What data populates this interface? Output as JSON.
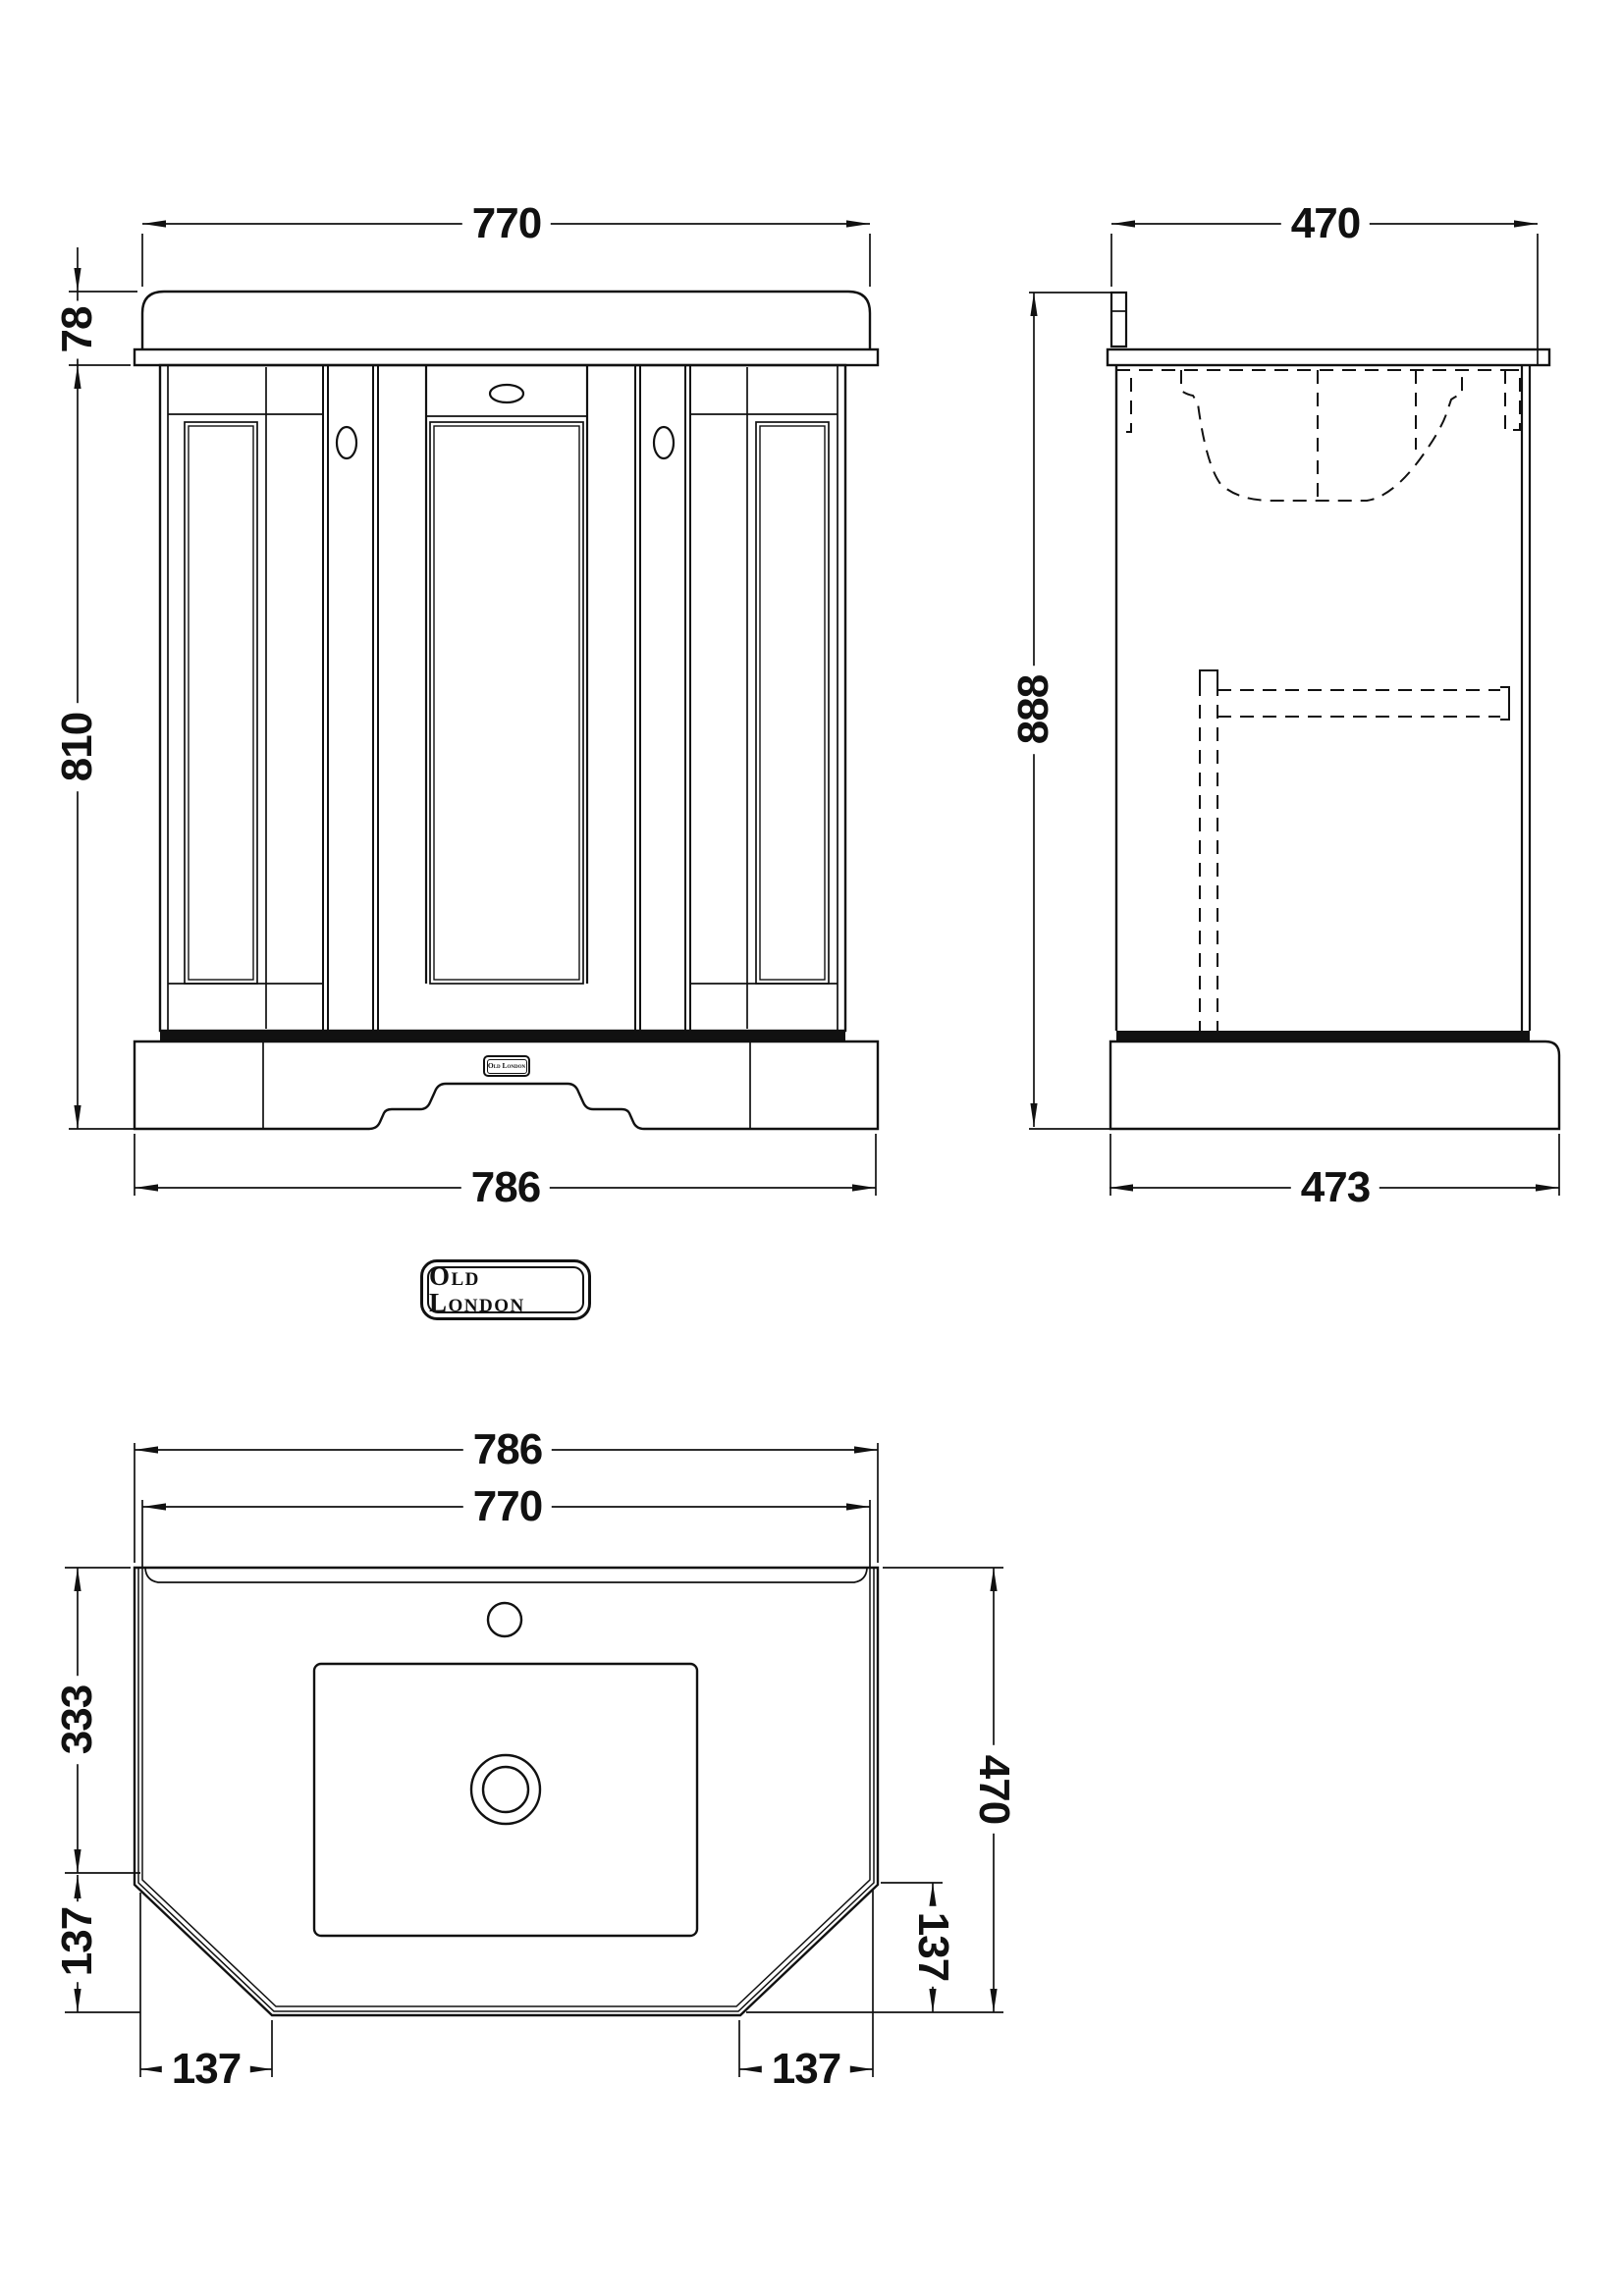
{
  "drawing": {
    "badge": {
      "text": "Old London"
    },
    "plinth_badge": {
      "text": "Old London"
    },
    "front": {
      "top_width": "770",
      "basin_height": "78",
      "cabinet_height": "810",
      "base_width": "786"
    },
    "side": {
      "top_depth": "470",
      "overall_height": "888",
      "base_depth": "473"
    },
    "plan": {
      "overall_width": "786",
      "basin_width": "770",
      "back_depth": "333",
      "left_chamfer_vertical": "137",
      "left_chamfer_horizontal": "137",
      "right_chamfer_vertical": "137",
      "right_chamfer_horizontal": "137",
      "overall_depth": "470"
    }
  }
}
